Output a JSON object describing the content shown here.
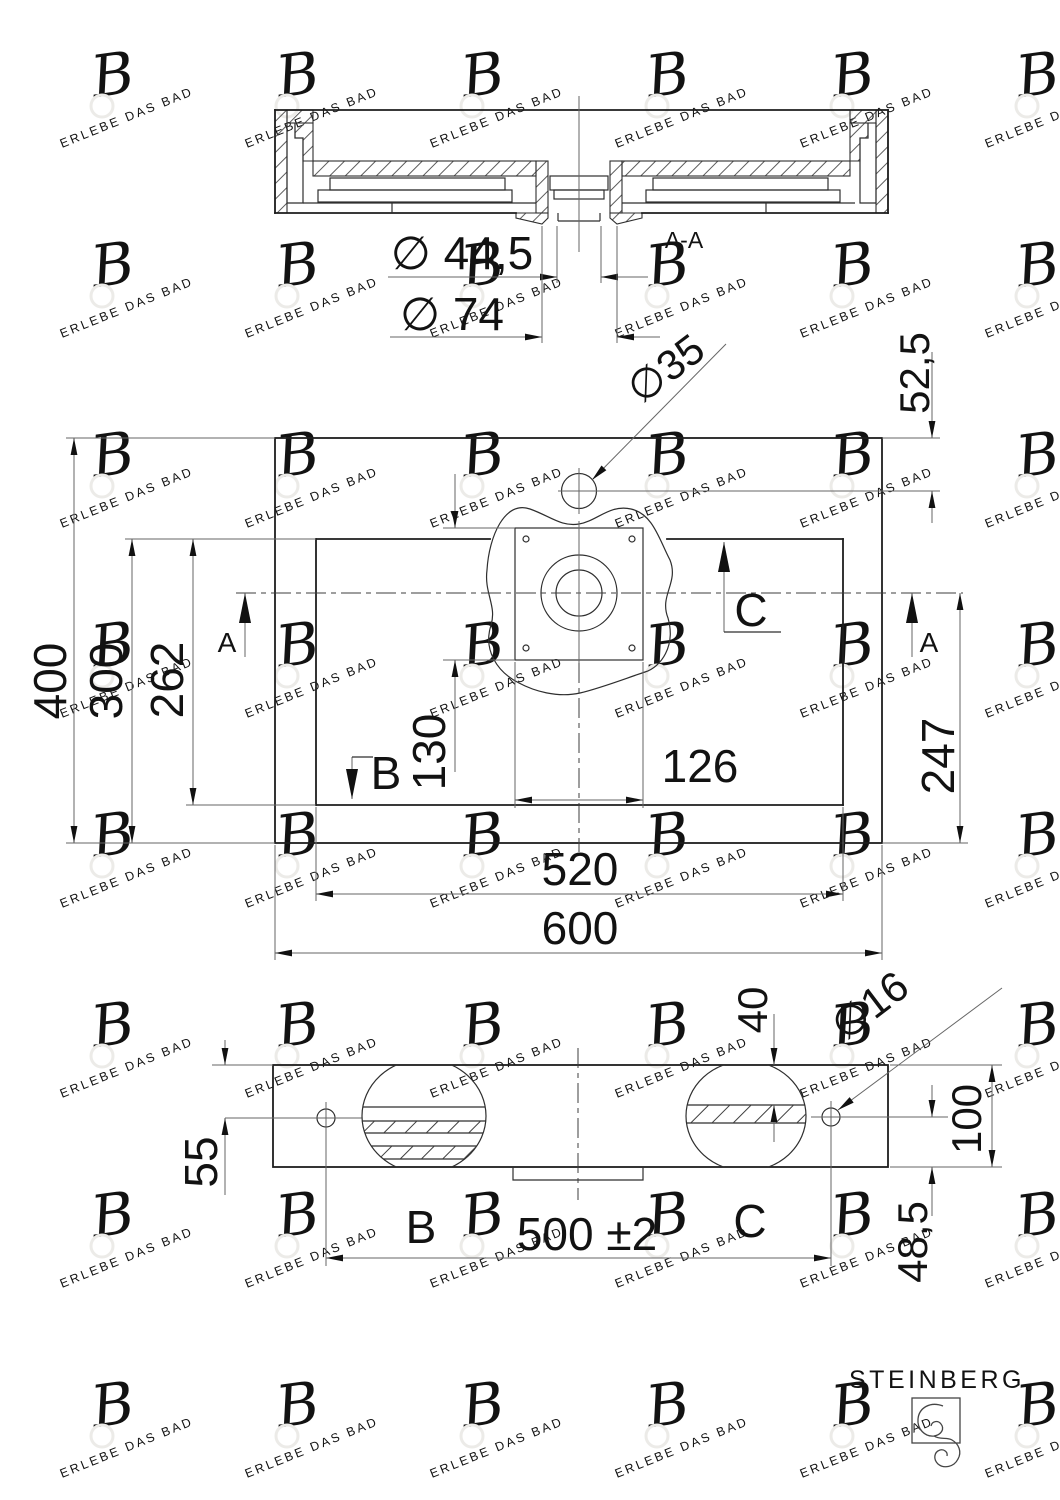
{
  "meta": {
    "brand": "STEINBERG",
    "watermark_text": "ERLEBE DAS BAD"
  },
  "colors": {
    "line_main": "#1d1d1d",
    "line_medium": "#2e2e2e",
    "line_thin": "#666666",
    "text": "#121212",
    "watermark": "#ecebe8",
    "brand": "#3d3d3d"
  },
  "section_view": {
    "title": "A-A",
    "dims": {
      "drain_inner_diameter": "∅ 44,5",
      "drain_flange_diameter": "∅ 74"
    }
  },
  "top_view": {
    "dims": {
      "tap_hole_diameter": "∅35",
      "tap_hole_offset": "52,5",
      "overall_depth": "400",
      "basin_opening_depth_outer": "300",
      "basin_opening_depth_inner": "262",
      "flange_height": "130",
      "flange_width": "126",
      "centerline_to_back": "247",
      "basin_opening_width": "520",
      "overall_width": "600"
    },
    "section_markers": {
      "a_left": "A",
      "a_right": "A",
      "b": "B",
      "c": "C"
    }
  },
  "front_view": {
    "dims": {
      "hole_top_offset": "55",
      "panel_top_offset": "40",
      "fixing_hole_diameter": "∅16",
      "overall_height": "100",
      "hole_bottom_offset": "48,5",
      "fixing_hole_spacing": "500 ±2"
    },
    "detail_labels": {
      "b": "B",
      "c": "C"
    }
  }
}
